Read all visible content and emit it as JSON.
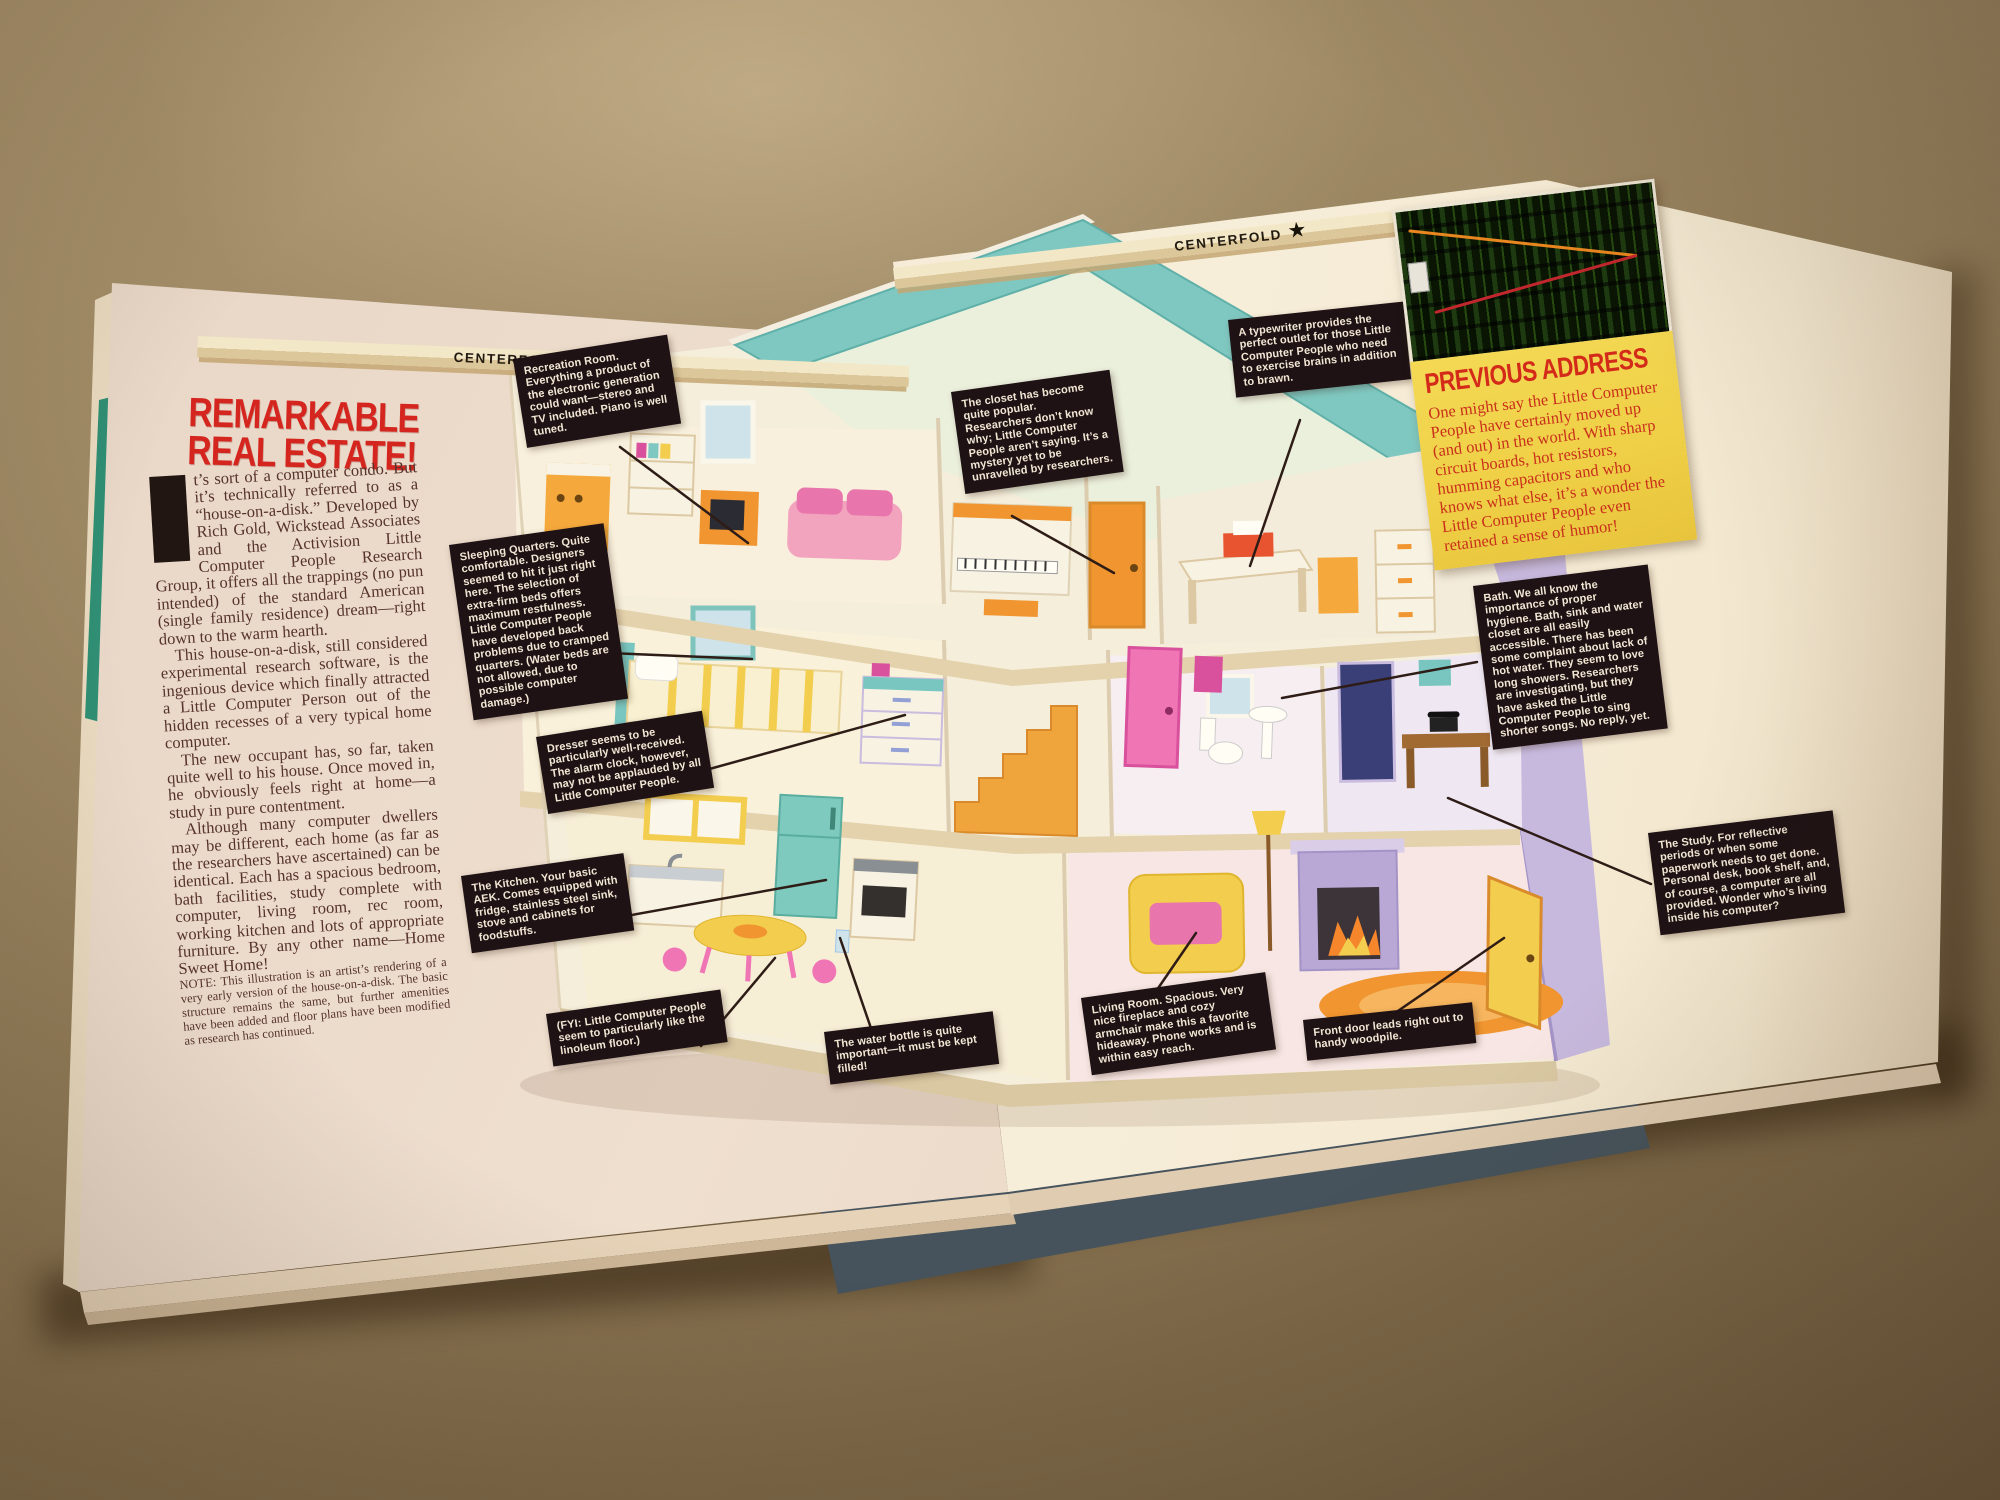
{
  "magazine": {
    "left_page": {
      "folio_label": "CENTERFOLD",
      "headline": [
        "REMARKABLE",
        "REAL ESTATE!"
      ],
      "drop_cap": "I",
      "paragraphs": [
        "t’s sort of a computer condo. But it’s technically referred to as a “house-on-a-disk.” Developed by Rich Gold, Wickstead Associates and the Activision Little Computer People Research Group, it offers all the trappings (no pun intended) of the standard American (single family residence) dream—right down to the warm hearth.",
        "This house-on-a-disk, still considered experimental research software, is the ingenious device which finally attracted a Little Computer Person out of the hidden recesses of a very typical home computer.",
        "The new occupant has, so far, taken quite well to his house. Once moved in, he obviously feels right at home—a study in pure contentment.",
        "Although many computer dwellers may be different, each home (as far as the researchers have ascertained) can be identical. Each has a spacious bedroom, bath facilities, study complete with computer, living room, rec room, working kitchen and lots of appropriate furniture. By any other name—Home Sweet Home!"
      ],
      "note": "NOTE: This illustration is an artist’s rendering of a very early version of the house-on-a-disk. The basic structure remains the same, but further amenities have been added and floor plans have been modified as research has continued."
    },
    "right_page": {
      "folio_label": "CENTERFOLD",
      "previous_address_title": "PREVIOUS ADDRESS",
      "previous_address_body": "One might say the Little Computer People have certainly moved up (and out) in the world. With sharp circuit boards, hot resistors, humming capacitors and who knows what else, it’s a wonder the Little Computer People even retained a sense of humor!"
    }
  },
  "callouts": [
    {
      "id": "recreation-room",
      "text": "Recreation Room. Everything a product of the electronic generation could want—stereo and TV included. Piano is well tuned."
    },
    {
      "id": "sleeping-quarters",
      "text": "Sleeping Quarters. Quite comfortable. Designers seemed to hit it just right here. The selection of extra-firm beds offers maximum restfulness. Little Computer People have developed back problems due to cramped quarters. (Water beds are not allowed, due to possible computer damage.)"
    },
    {
      "id": "dresser",
      "text": "Dresser seems to be particularly well-received. The alarm clock, however, may not be applauded by all Little Computer People."
    },
    {
      "id": "kitchen",
      "text": "The Kitchen. Your basic AEK. Comes equipped with fridge, stainless steel sink, stove and cabinets for foodstuffs."
    },
    {
      "id": "fyi-linoleum",
      "text": "(FYI: Little Computer People seem to particularly like the linoleum floor.)"
    },
    {
      "id": "water-bottle",
      "text": "The water bottle is quite important—it must be kept filled!"
    },
    {
      "id": "closet",
      "text": "The closet has become quite popular. Researchers don’t know why; Little Computer People aren’t saying. It’s a mystery yet to be unravelled by researchers."
    },
    {
      "id": "typewriter",
      "text": "A typewriter provides the perfect outlet for those Little Computer People who need to exercise brains in addition to brawn."
    },
    {
      "id": "bath",
      "text": "Bath. We all know the importance of proper hygiene. Bath, sink and water closet are all easily accessible. There has been some complaint about lack of hot water. They seem to love long showers. Researchers are investigating, but they have asked the Little Computer People to sing shorter songs. No reply, yet."
    },
    {
      "id": "study",
      "text": "The Study. For reflective periods or when some paperwork needs to get done. Personal desk, book shelf, and, of course, a computer are all provided. Wonder who’s living inside his computer?"
    },
    {
      "id": "living-room",
      "text": "Living Room. Spacious. Very nice fireplace and cozy armchair make this a favorite hideaway. Phone works and is within easy reach."
    },
    {
      "id": "front-door",
      "text": "Front door leads right out to handy woodpile."
    }
  ],
  "colors": {
    "paper_kraft": "#9c8763",
    "page_cream": "#f3e7d4",
    "headline_red": "#d4261f",
    "callout_black": "#1e1214",
    "callout_text": "#f2e6d4",
    "note_yellow": "#f0d14b",
    "note_red": "#c9301c",
    "roof_teal": "#7fc8c1",
    "wall_cream": "#f5eeda",
    "side_wall_lavender": "#c7b9dd"
  }
}
